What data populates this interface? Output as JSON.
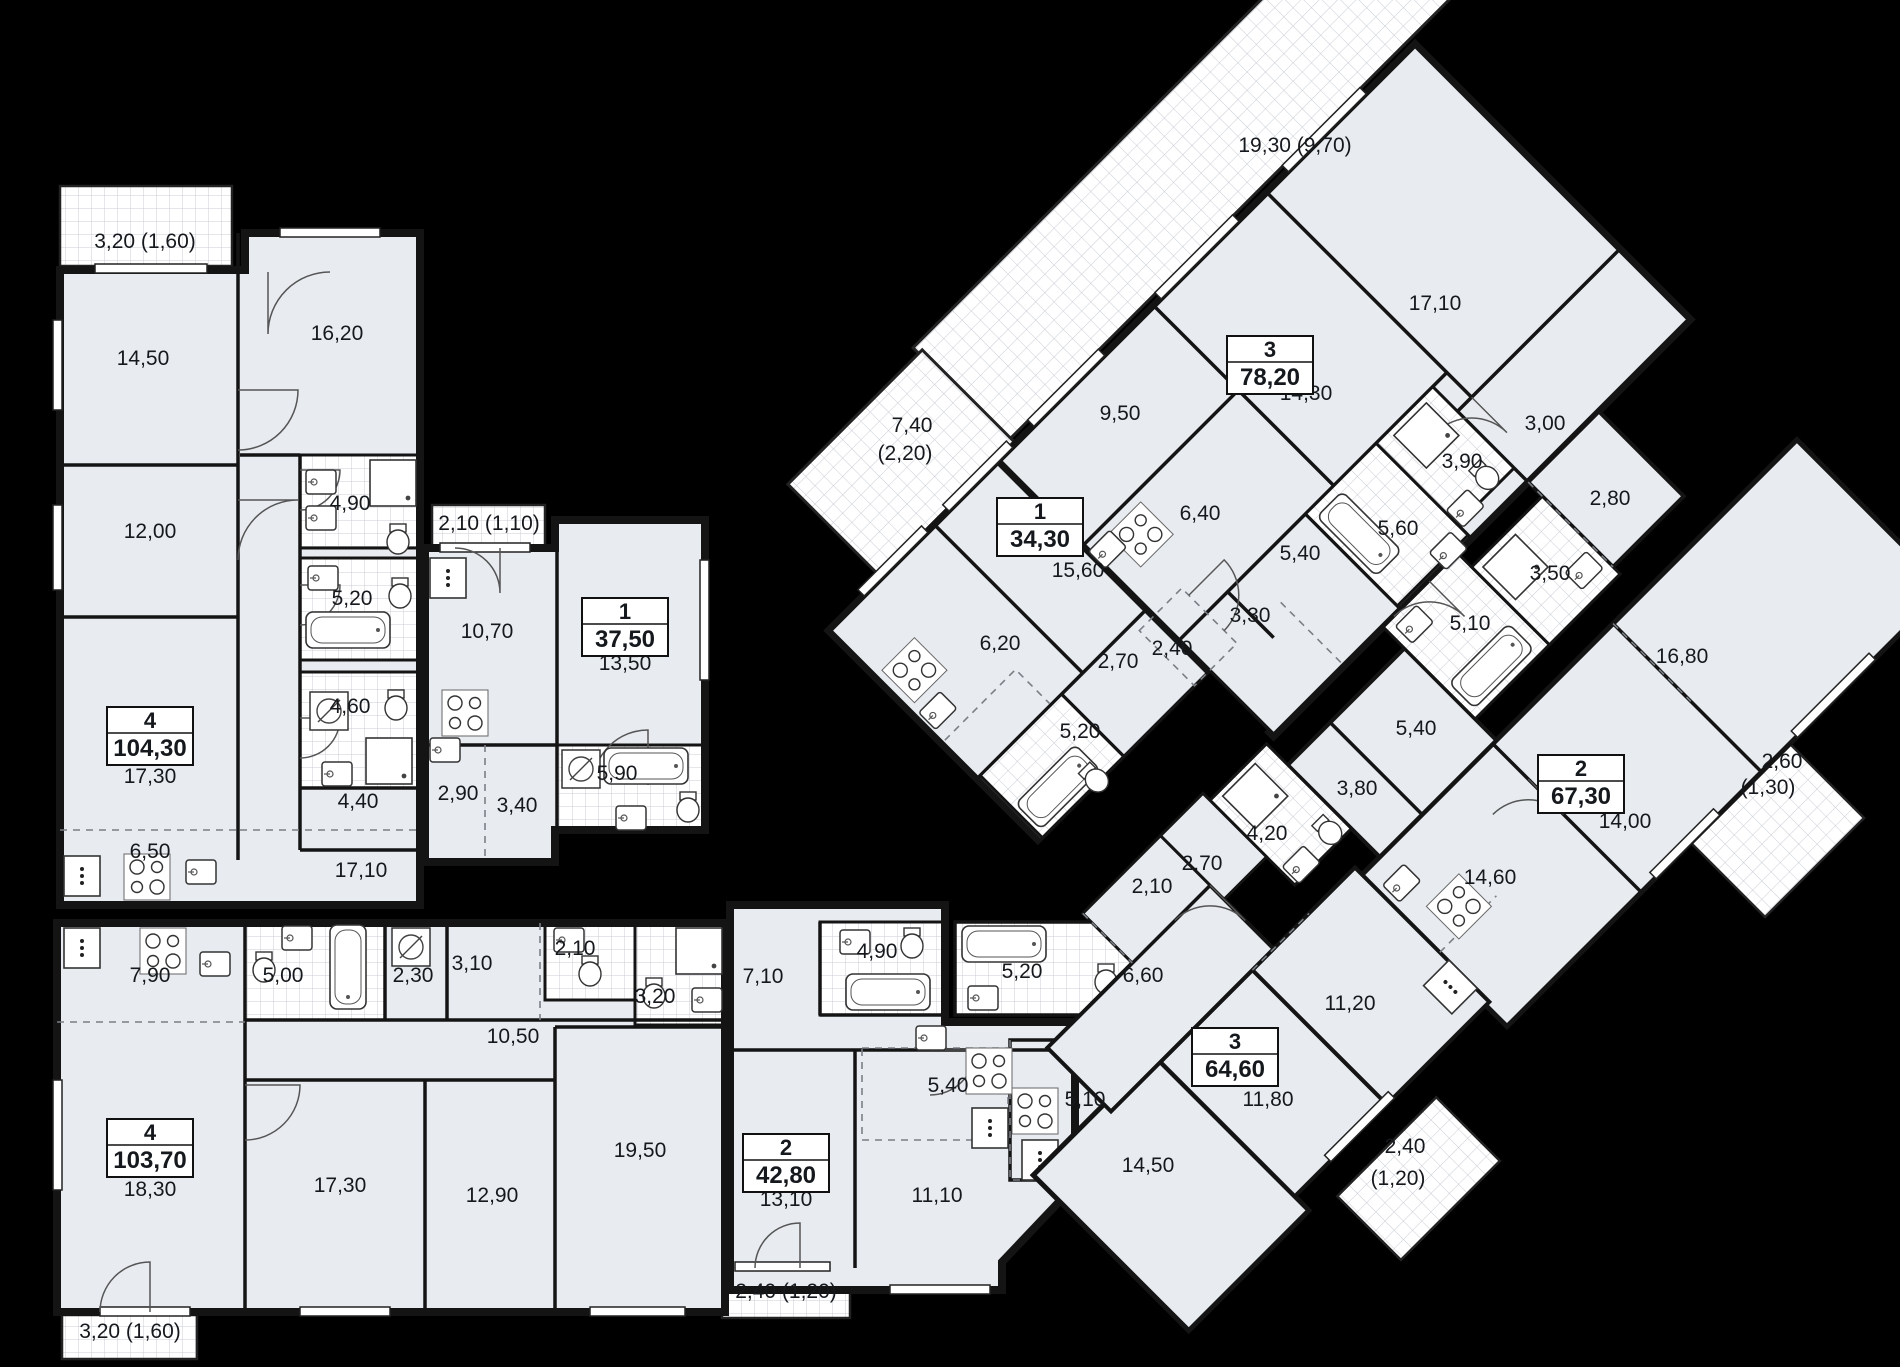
{
  "plan_title": "floor-plan",
  "colors": {
    "background": "#000000",
    "room_fill": "#e8ecf1",
    "room_fill_alt": "#eef1f5",
    "wall": "#141414",
    "hatch_line": "#c8cdd4",
    "dash": "#7a7f86",
    "label_text": "#15181c",
    "box_border": "#111111",
    "box_fill": "#ffffff"
  },
  "apartment_boxes": [
    {
      "num": "4",
      "area": "104,30",
      "cx": 150,
      "cy": 736
    },
    {
      "num": "1",
      "area": "37,50",
      "cx": 625,
      "cy": 627
    },
    {
      "num": "4",
      "area": "103,70",
      "cx": 150,
      "cy": 1148
    },
    {
      "num": "2",
      "area": "42,80",
      "cx": 786,
      "cy": 1163
    },
    {
      "num": "1",
      "area": "34,30",
      "cx": 1040,
      "cy": 527
    },
    {
      "num": "3",
      "area": "78,20",
      "cx": 1270,
      "cy": 365
    },
    {
      "num": "2",
      "area": "67,30",
      "cx": 1581,
      "cy": 784
    },
    {
      "num": "3",
      "area": "64,60",
      "cx": 1235,
      "cy": 1057
    }
  ],
  "room_labels": [
    {
      "t": "3,20 (1,60)",
      "x": 145,
      "y": 248
    },
    {
      "t": "14,50",
      "x": 143,
      "y": 365
    },
    {
      "t": "16,20",
      "x": 337,
      "y": 340
    },
    {
      "t": "12,00",
      "x": 150,
      "y": 538
    },
    {
      "t": "4,90",
      "x": 350,
      "y": 510
    },
    {
      "t": "5,20",
      "x": 352,
      "y": 605
    },
    {
      "t": "4,60",
      "x": 350,
      "y": 713
    },
    {
      "t": "4,40",
      "x": 358,
      "y": 808
    },
    {
      "t": "17,30",
      "x": 150,
      "y": 783
    },
    {
      "t": "6,50",
      "x": 150,
      "y": 858
    },
    {
      "t": "17,10",
      "x": 361,
      "y": 877
    },
    {
      "t": "2,10 (1,10)",
      "x": 489,
      "y": 530
    },
    {
      "t": "10,70",
      "x": 487,
      "y": 638
    },
    {
      "t": "13,50",
      "x": 625,
      "y": 670
    },
    {
      "t": "2,90",
      "x": 458,
      "y": 800
    },
    {
      "t": "3,40",
      "x": 517,
      "y": 812
    },
    {
      "t": "5,90",
      "x": 617,
      "y": 780
    },
    {
      "t": "7,90",
      "x": 150,
      "y": 982
    },
    {
      "t": "5,00",
      "x": 283,
      "y": 982
    },
    {
      "t": "2,30",
      "x": 413,
      "y": 982
    },
    {
      "t": "3,10",
      "x": 472,
      "y": 970
    },
    {
      "t": "2,10",
      "x": 575,
      "y": 955
    },
    {
      "t": "3,20",
      "x": 655,
      "y": 1003
    },
    {
      "t": "10,50",
      "x": 513,
      "y": 1043
    },
    {
      "t": "18,30",
      "x": 150,
      "y": 1196
    },
    {
      "t": "17,30",
      "x": 340,
      "y": 1192
    },
    {
      "t": "12,90",
      "x": 492,
      "y": 1202
    },
    {
      "t": "19,50",
      "x": 640,
      "y": 1157
    },
    {
      "t": "3,20 (1,60)",
      "x": 130,
      "y": 1338
    },
    {
      "t": "7,10",
      "x": 763,
      "y": 983
    },
    {
      "t": "4,90",
      "x": 877,
      "y": 958
    },
    {
      "t": "13,10",
      "x": 786,
      "y": 1206
    },
    {
      "t": "5,40",
      "x": 948,
      "y": 1092
    },
    {
      "t": "11,10",
      "x": 937,
      "y": 1202
    },
    {
      "t": "2,40 (1,20)",
      "x": 786,
      "y": 1298
    },
    {
      "t": "5,20",
      "x": 1022,
      "y": 978
    },
    {
      "t": "5,10",
      "x": 1085,
      "y": 1106
    },
    {
      "t": "19,30 (9,70)",
      "x": 1295,
      "y": 152
    },
    {
      "t": "9,50",
      "x": 1120,
      "y": 420
    },
    {
      "t": "14,30",
      "x": 1306,
      "y": 400
    },
    {
      "t": "17,10",
      "x": 1435,
      "y": 310
    },
    {
      "t": "6,40",
      "x": 1200,
      "y": 520
    },
    {
      "t": "5,40",
      "x": 1300,
      "y": 560
    },
    {
      "t": "3,30",
      "x": 1250,
      "y": 622
    },
    {
      "t": "2,40",
      "x": 1172,
      "y": 655
    },
    {
      "t": "5,60",
      "x": 1398,
      "y": 535
    },
    {
      "t": "3,90",
      "x": 1462,
      "y": 468
    },
    {
      "t": "3,00",
      "x": 1545,
      "y": 430
    },
    {
      "t": "7,40",
      "x": 912,
      "y": 432
    },
    {
      "t": "(2,20)",
      "x": 905,
      "y": 460
    },
    {
      "t": "15,60",
      "x": 1078,
      "y": 577
    },
    {
      "t": "6,20",
      "x": 1000,
      "y": 650
    },
    {
      "t": "2,70",
      "x": 1118,
      "y": 668
    },
    {
      "t": "5,20",
      "x": 1080,
      "y": 738
    },
    {
      "t": "2,80",
      "x": 1610,
      "y": 505
    },
    {
      "t": "3,50",
      "x": 1550,
      "y": 580
    },
    {
      "t": "5,10",
      "x": 1470,
      "y": 630
    },
    {
      "t": "5,40",
      "x": 1416,
      "y": 735
    },
    {
      "t": "3,80",
      "x": 1357,
      "y": 795
    },
    {
      "t": "4,20",
      "x": 1267,
      "y": 840
    },
    {
      "t": "14,60",
      "x": 1490,
      "y": 884
    },
    {
      "t": "14,00",
      "x": 1625,
      "y": 828
    },
    {
      "t": "16,80",
      "x": 1682,
      "y": 663
    },
    {
      "t": "2,60",
      "x": 1782,
      "y": 768
    },
    {
      "t": "(1,30)",
      "x": 1768,
      "y": 794
    },
    {
      "t": "2,10",
      "x": 1152,
      "y": 893
    },
    {
      "t": "2,70",
      "x": 1202,
      "y": 870
    },
    {
      "t": "6,60",
      "x": 1143,
      "y": 982
    },
    {
      "t": "11,20",
      "x": 1350,
      "y": 1010
    },
    {
      "t": "11,80",
      "x": 1268,
      "y": 1106
    },
    {
      "t": "14,50",
      "x": 1148,
      "y": 1172
    },
    {
      "t": "2,40",
      "x": 1405,
      "y": 1153
    },
    {
      "t": "(1,20)",
      "x": 1398,
      "y": 1185
    }
  ]
}
